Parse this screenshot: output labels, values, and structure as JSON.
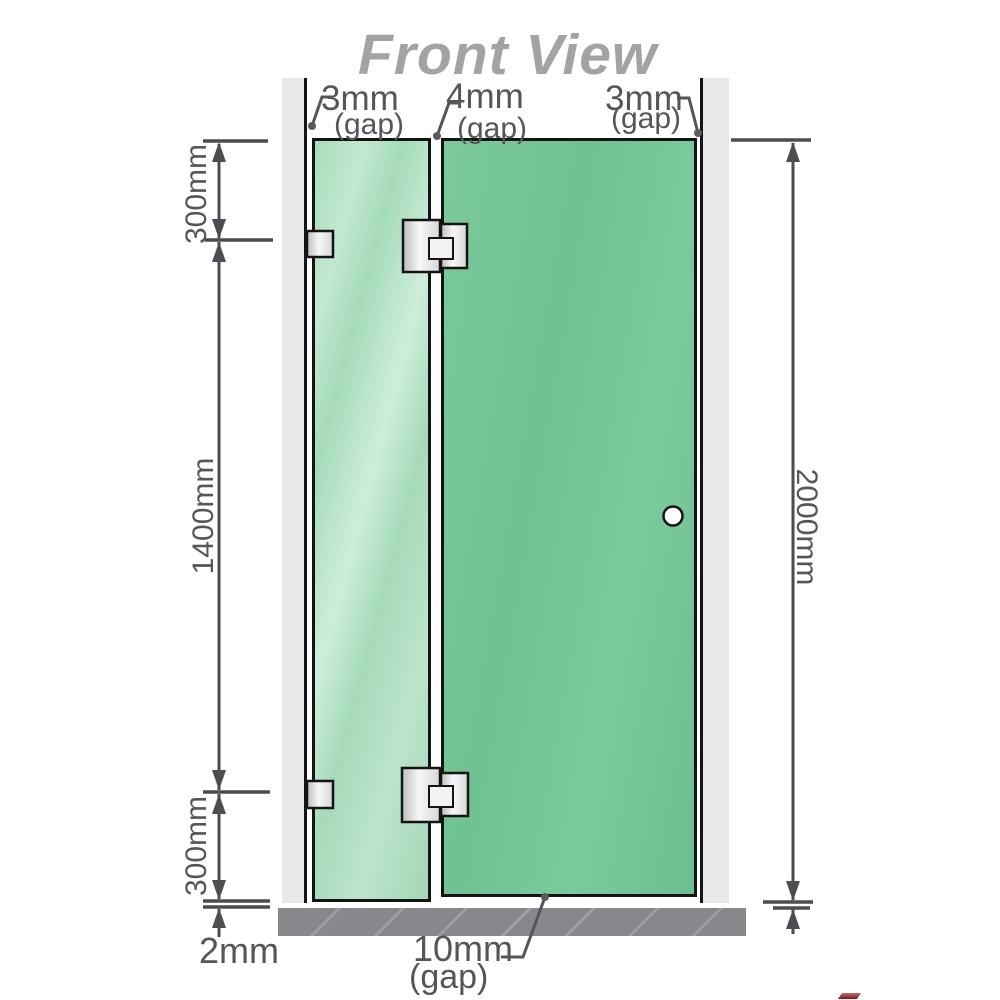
{
  "title": "Front View",
  "labels": {
    "gaps": {
      "left": {
        "value": "3mm",
        "caption": "(gap)"
      },
      "middle": {
        "value": "4mm",
        "caption": "(gap)"
      },
      "right": {
        "value": "3mm",
        "caption": "(gap)"
      },
      "bottom": {
        "value": "10mm",
        "caption": "(gap)"
      },
      "floor": {
        "value": "2mm"
      }
    },
    "dimensions": {
      "left_top": "300mm",
      "left_middle": "1400mm",
      "left_bottom": "300mm",
      "right_full": "2000mm"
    }
  },
  "components": {
    "left_wall": "wall",
    "right_wall": "wall",
    "fixed_panel": "fixed glass panel",
    "door_panel": "hinged glass door",
    "door_handle": "round knob handle",
    "hinges": [
      "wall-to-glass bracket top",
      "glass-to-glass hinge top",
      "wall-to-glass bracket bottom",
      "glass-to-glass hinge bottom"
    ],
    "floor": "floor slab"
  },
  "colors": {
    "glass_fixed": "#a6dabb",
    "glass_door": "#72c493",
    "wall": "#e8e8e8",
    "floor": "#87878c",
    "line": "#4c4c52",
    "metal": "#d9d9d9",
    "outline": "#141414",
    "title": "#a3a3a3",
    "label_text": "#55555a"
  }
}
